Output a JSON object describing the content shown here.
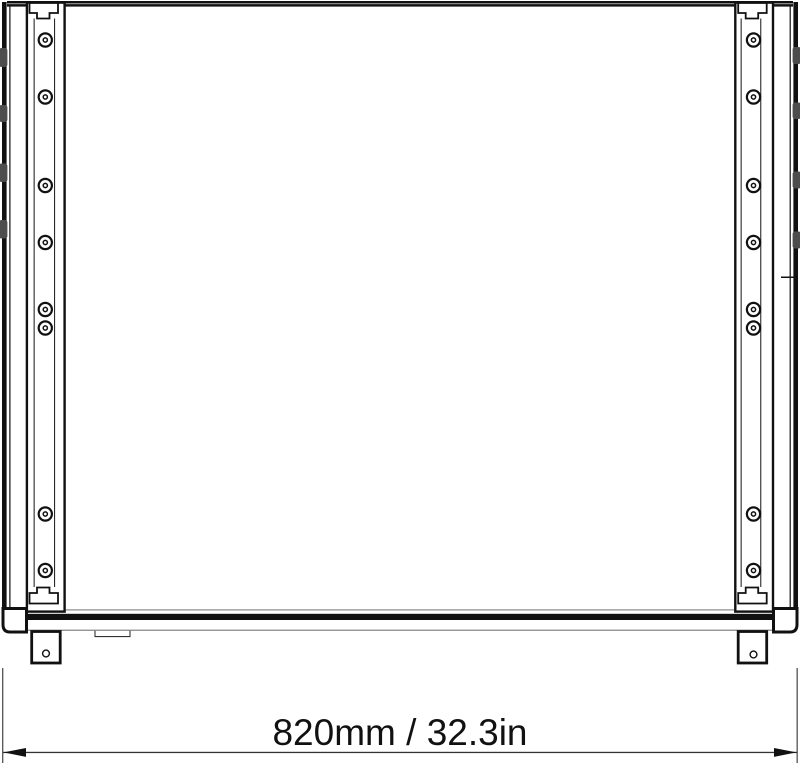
{
  "diagram": {
    "type": "technical-drawing-front-view",
    "dimension_label": "820mm / 32.3in",
    "ink_color": "#111111",
    "tab_color": "#4d4d4d"
  }
}
